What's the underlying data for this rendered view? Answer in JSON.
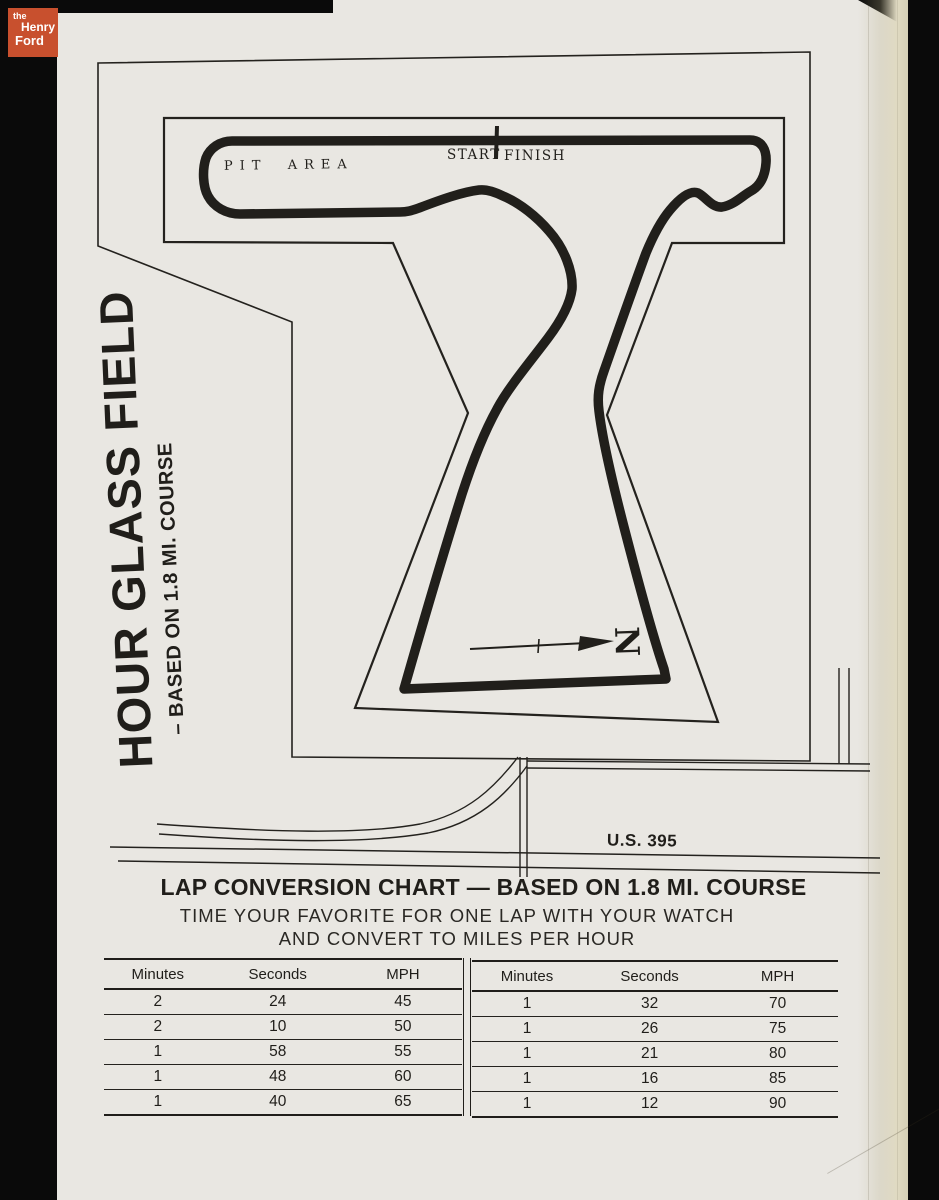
{
  "colors": {
    "paper": "#e9e7e2",
    "ink": "#201e1a",
    "logo_background": "#c8502e",
    "scan_background": "#0a0a0a"
  },
  "logo": {
    "the": "the",
    "henry": "Henry",
    "ford": "Ford"
  },
  "map": {
    "title": "HOUR GLASS FIELD",
    "subtitle": "– BASED ON 1.8 MI. COURSE",
    "pit_area_label": "PIT AREA",
    "start_label": "START",
    "finish_label": "FINISH",
    "north_label": "N",
    "highway_label": "U.S. 395"
  },
  "chart": {
    "title": "LAP CONVERSION CHART — BASED ON 1.8 MI. COURSE",
    "subtitle_line1": "TIME YOUR FAVORITE FOR ONE LAP WITH YOUR WATCH",
    "subtitle_line2": "AND CONVERT TO MILES PER HOUR",
    "tables": [
      {
        "headers": [
          "Minutes",
          "Seconds",
          "MPH"
        ],
        "rows": [
          [
            "2",
            "24",
            "45"
          ],
          [
            "2",
            "10",
            "50"
          ],
          [
            "1",
            "58",
            "55"
          ],
          [
            "1",
            "48",
            "60"
          ],
          [
            "1",
            "40",
            "65"
          ]
        ]
      },
      {
        "headers": [
          "Minutes",
          "Seconds",
          "MPH"
        ],
        "rows": [
          [
            "1",
            "32",
            "70"
          ],
          [
            "1",
            "26",
            "75"
          ],
          [
            "1",
            "21",
            "80"
          ],
          [
            "1",
            "16",
            "85"
          ],
          [
            "1",
            "12",
            "90"
          ]
        ]
      }
    ]
  },
  "chart_data": {
    "type": "table",
    "title": "LAP CONVERSION CHART — BASED ON 1.8 MI. COURSE",
    "columns": [
      "Minutes",
      "Seconds",
      "MPH"
    ],
    "rows": [
      [
        2,
        24,
        45
      ],
      [
        2,
        10,
        50
      ],
      [
        1,
        58,
        55
      ],
      [
        1,
        48,
        60
      ],
      [
        1,
        40,
        65
      ],
      [
        1,
        32,
        70
      ],
      [
        1,
        26,
        75
      ],
      [
        1,
        21,
        80
      ],
      [
        1,
        16,
        85
      ],
      [
        1,
        12,
        90
      ]
    ]
  }
}
